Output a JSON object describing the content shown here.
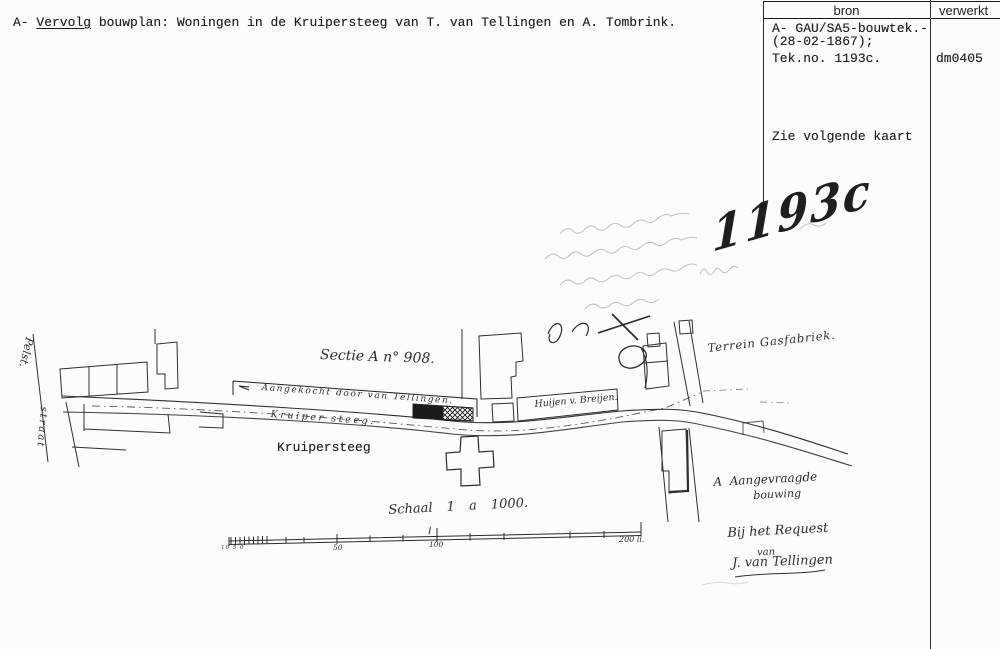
{
  "document": {
    "title": {
      "prefix": "A- ",
      "underlined": "Vervolg",
      "rest": " bouwplan: Woningen in de Kruipersteeg van T. van Tellingen en A. Tombrink."
    },
    "register": {
      "col_bron": "bron",
      "col_verwerkt": "verwerkt",
      "bron_line1": "A- GAU/SA5-bouwtek.-",
      "bron_line2": "(28-02-1867);",
      "bron_line3": "Tek.no. 1193c.",
      "verwerkt_value": "dm0405",
      "note": "Zie volgende kaart"
    }
  },
  "plan": {
    "drawing_number": "1193c",
    "labels": {
      "sectie": "Sectie A n° 908.",
      "aangekocht": "Aangekocht door van Tellingen.",
      "kruiper_steeg": "Kruiper steeg.",
      "kruipersteeg_typed": "Kruipersteeg",
      "huijen": "Huijen v. Breijen.",
      "gasfabriek": "Terrein Gasfabriek.",
      "aangevraagd1": "A  Aangevraagde",
      "aangevraagd2": "bouwing",
      "request1": "Bij het Request",
      "request2": "van",
      "request3": "J. van Tellingen",
      "street_top": "Pelst.",
      "street_bottom": "straat"
    },
    "scale": {
      "caption": "Schaal  1 a 1000.",
      "minor": "10 5 0",
      "t50": "50",
      "t100": "100",
      "t200": "200 ll."
    }
  }
}
